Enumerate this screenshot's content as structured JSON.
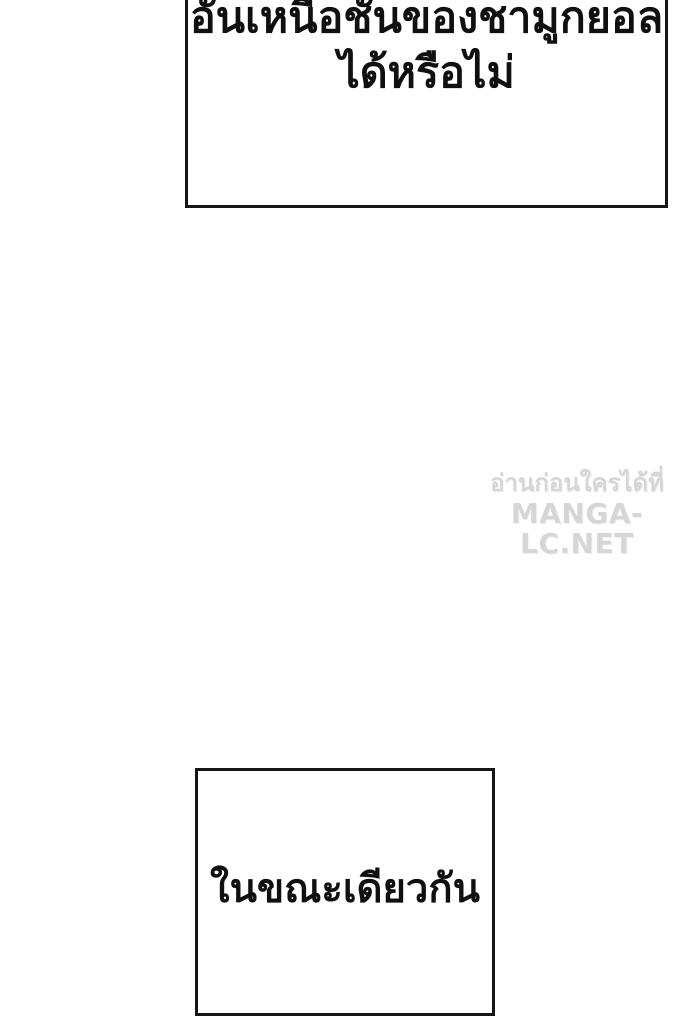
{
  "page": {
    "background_color": "#ffffff"
  },
  "colors": {
    "panel_border": "#151515",
    "caption_text": "#101010",
    "watermark_text": "#d6d6d6"
  },
  "panels": {
    "top": {
      "line1": "อันเหนือชั้นของชามูกยอล",
      "line2": "ได้หรือไม่"
    },
    "bottom": {
      "text": "ในขณะเดียวกัน"
    }
  },
  "watermark": {
    "line1": "อ่านก่อนใครได้ที่",
    "line2": "MANGA-LC.NET"
  }
}
